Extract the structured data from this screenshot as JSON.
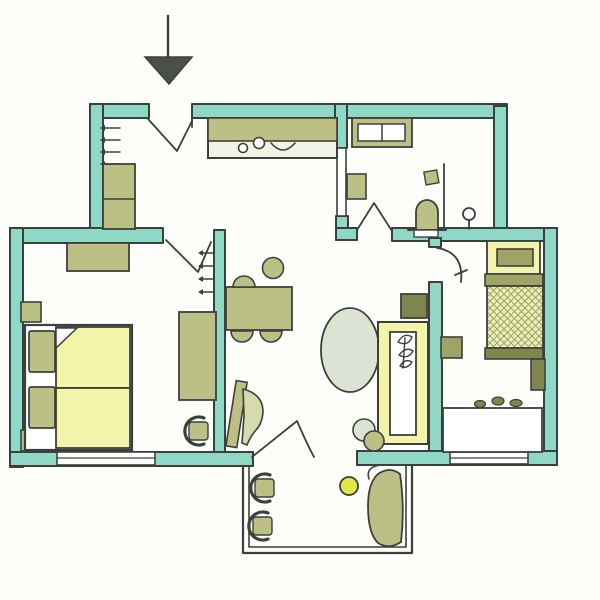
{
  "drawing": {
    "kind": "hand-drawn apartment floor plan sketch",
    "entrance_symbol": "arrow-down"
  },
  "palette": {
    "paper": "#fdfdfa",
    "ink": "#3c403c",
    "wall": "#8fd8c6",
    "olive": "#bcc084",
    "olive_dark": "#9fa363",
    "olive_deep": "#80844e",
    "olive_pale": "#d6daad",
    "yellow": "#f3f3a9",
    "yellow_pale": "#ecefb9",
    "yellow_bright": "#e3e44e",
    "sage": "#dde3d4",
    "counter": "#f2f3e4",
    "white": "#ffffff",
    "arrow": "#4b4f49"
  },
  "rooms": {
    "entry_hall": {
      "items": [
        "coat-hooks",
        "hall-wardrobe",
        "entry-door"
      ]
    },
    "kitchen": {
      "items": [
        "kitchen-counter",
        "sink-bowls",
        "basin-arc"
      ]
    },
    "bathroom": {
      "items": [
        "vanity-double-sink",
        "wall-shelf",
        "paper-holder",
        "shower-screen",
        "toilet",
        "wash-basin",
        "bathroom-door"
      ]
    },
    "bedroom_west": {
      "items": [
        "dresser",
        "double-bed",
        "two-pillows",
        "folded-sheet-corner",
        "nightstand-top",
        "nightstand-bottom",
        "wardrobe",
        "chair",
        "radiator-marks",
        "window"
      ]
    },
    "living_dining": {
      "items": [
        "dining-table",
        "four-chairs",
        "round-rug",
        "sofa",
        "sofa-plant-leaves",
        "head-cushion",
        "two-poufs",
        "leaning-board",
        "fan-plant",
        "balcony-door"
      ]
    },
    "bedroom_east": {
      "items": [
        "single-bed",
        "pillow",
        "nightstand",
        "side-unit",
        "desk",
        "desk-items",
        "window",
        "room-door"
      ]
    },
    "balcony": {
      "items": [
        "railing",
        "chair-1",
        "chair-2",
        "side-table",
        "lounge-chair"
      ]
    }
  }
}
